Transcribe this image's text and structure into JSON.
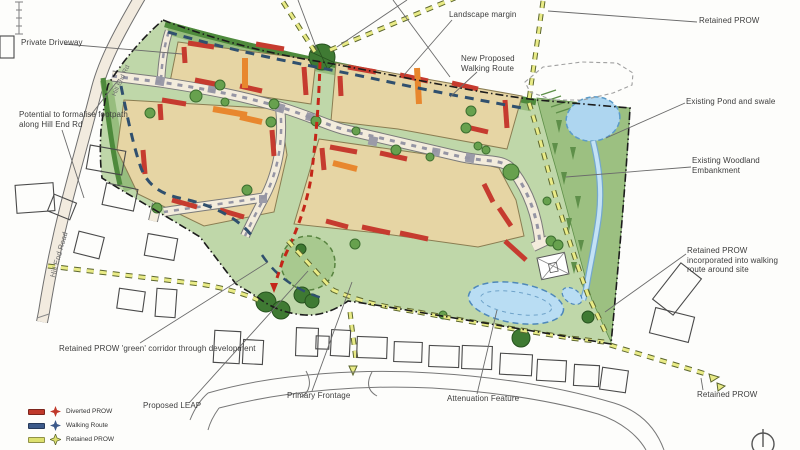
{
  "plan": {
    "annotations": {
      "private_driveway": "Private Driveway",
      "potential_footpath": "Potential to formalise footpath along Hill End Rd",
      "landscape_margin": "Landscape margin",
      "retained_prow_top": "Retained PROW",
      "new_walking_route": "New Proposed Walking Route",
      "existing_pond": "Existing Pond and swale",
      "woodland_embankment": "Existing Woodland Embankment",
      "prow_incorporated": "Retained PROW incorporated into walking route around site",
      "green_corridor": "Retained PROW 'green' corridor through development",
      "proposed_leap": "Proposed LEAP",
      "primary_frontage": "Primary Frontage",
      "attenuation_feature": "Attenuation Feature",
      "retained_prow_bottom": "Retained PROW"
    },
    "road_names": {
      "hill_end_road": "Hill End Road",
      "hill_end_rd": "Hill End Rd"
    },
    "legend": {
      "items": [
        {
          "label": "Diverted PROW",
          "color": "#c0392b"
        },
        {
          "label": "Walking Route",
          "color": "#3d5a8a"
        },
        {
          "label": "Retained PROW",
          "color": "#dde06e"
        }
      ]
    },
    "colors": {
      "site_green": "#bfd7a9",
      "margin_green": "#97bd7e",
      "hedge_green": "#4e8a3c",
      "embankment_green": "#9cc081",
      "parcel_tan": "#e6d5a4",
      "building_red": "#c63b2f",
      "building_orange": "#e8872e",
      "road_cream": "#f2ebdf",
      "water_blue": "#aed6f0",
      "water_outline": "#5b9bc8",
      "route_retained_yellow": "#e9eb86",
      "route_walking_blue": "#30506e",
      "route_diverted_red": "#c42619",
      "boundary_black": "#1c1c1c"
    }
  }
}
